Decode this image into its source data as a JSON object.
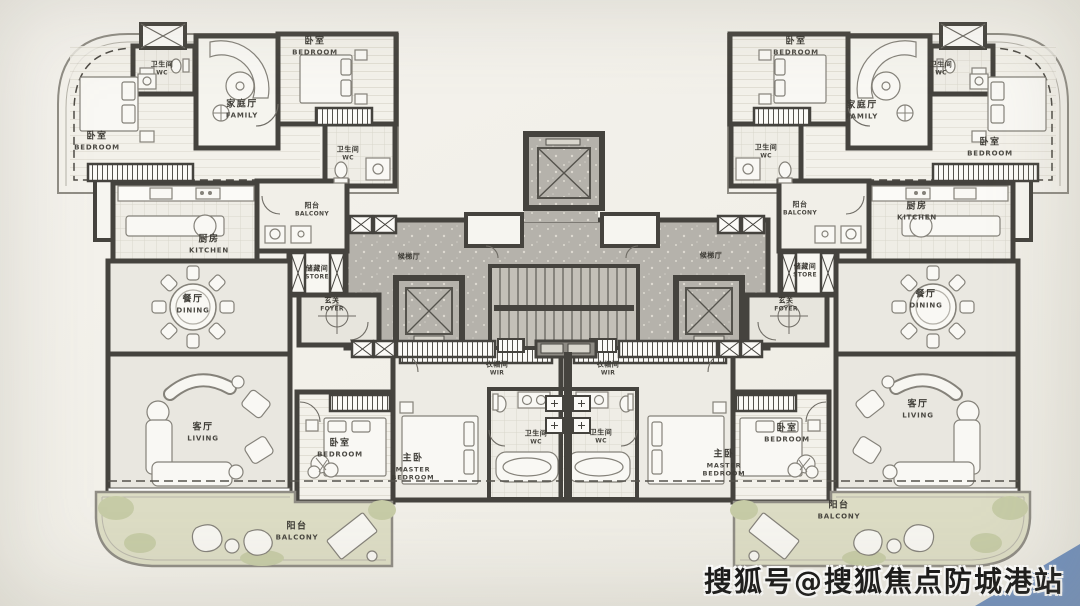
{
  "watermark": {
    "text": "搜狐号@搜狐焦点防城港站"
  },
  "colors": {
    "wall": "#45433e",
    "corridor_gray": "#b5b2aa",
    "balcony_green": "#dcdcc4",
    "plant_green": "#c6cba6",
    "paper": "#f2f0e9",
    "marble": "#e7e5dd",
    "watermark_accent_blue": "#6f8fbe"
  },
  "rooms": {
    "left": {
      "bedroom_nw": {
        "zh": "卧室",
        "en": "BEDROOM"
      },
      "wc_nw": {
        "zh": "卫生间",
        "en": "WC"
      },
      "family": {
        "zh": "家庭厅",
        "en": "FAMILY"
      },
      "bedroom_n": {
        "zh": "卧室",
        "en": "BEDROOM"
      },
      "wc_n": {
        "zh": "卫生间",
        "en": "WC"
      },
      "balcony_n": {
        "zh": "阳台",
        "en": "BALCONY"
      },
      "kitchen": {
        "zh": "厨房",
        "en": "KITCHEN"
      },
      "store": {
        "zh": "储藏间",
        "en": "STORE"
      },
      "foyer": {
        "zh": "玄关",
        "en": "FOYER"
      },
      "dining": {
        "zh": "餐厅",
        "en": "DINING"
      },
      "lobby": {
        "zh": "候梯厅",
        "en": ""
      },
      "living": {
        "zh": "客厅",
        "en": "LIVING"
      },
      "bedroom_s": {
        "zh": "卧室",
        "en": "BEDROOM"
      },
      "master": {
        "zh": "主卧",
        "en": "MASTER BEDROOM"
      },
      "wir": {
        "zh": "衣帽间",
        "en": "WIR"
      },
      "wc_s": {
        "zh": "卫生间",
        "en": "WC"
      },
      "balcony_s": {
        "zh": "阳台",
        "en": "BALCONY"
      }
    },
    "right": {
      "bedroom_n": {
        "zh": "卧室",
        "en": "BEDROOM"
      },
      "bedroom_ne": {
        "zh": "卧室",
        "en": "BEDROOM"
      },
      "wc_ne": {
        "zh": "卫生间",
        "en": "WC"
      },
      "family": {
        "zh": "家庭厅",
        "en": "FAMILY"
      },
      "wc_n": {
        "zh": "卫生间",
        "en": "WC"
      },
      "balcony_n": {
        "zh": "阳台",
        "en": "BALCONY"
      },
      "kitchen": {
        "zh": "厨房",
        "en": "KITCHEN"
      },
      "store": {
        "zh": "储藏间",
        "en": "STORE"
      },
      "foyer": {
        "zh": "玄关",
        "en": "FOYER"
      },
      "dining": {
        "zh": "餐厅",
        "en": "DINING"
      },
      "lobby": {
        "zh": "候梯厅",
        "en": ""
      },
      "living": {
        "zh": "客厅",
        "en": "LIVING"
      },
      "bedroom_s": {
        "zh": "卧室",
        "en": "BEDROOM"
      },
      "master": {
        "zh": "主卧",
        "en": "MASTER BEDROOM"
      },
      "wir": {
        "zh": "衣帽间",
        "en": "WIR"
      },
      "wc_s": {
        "zh": "卫生间",
        "en": "WC"
      },
      "balcony_s": {
        "zh": "阳台",
        "en": "BALCONY"
      }
    }
  }
}
